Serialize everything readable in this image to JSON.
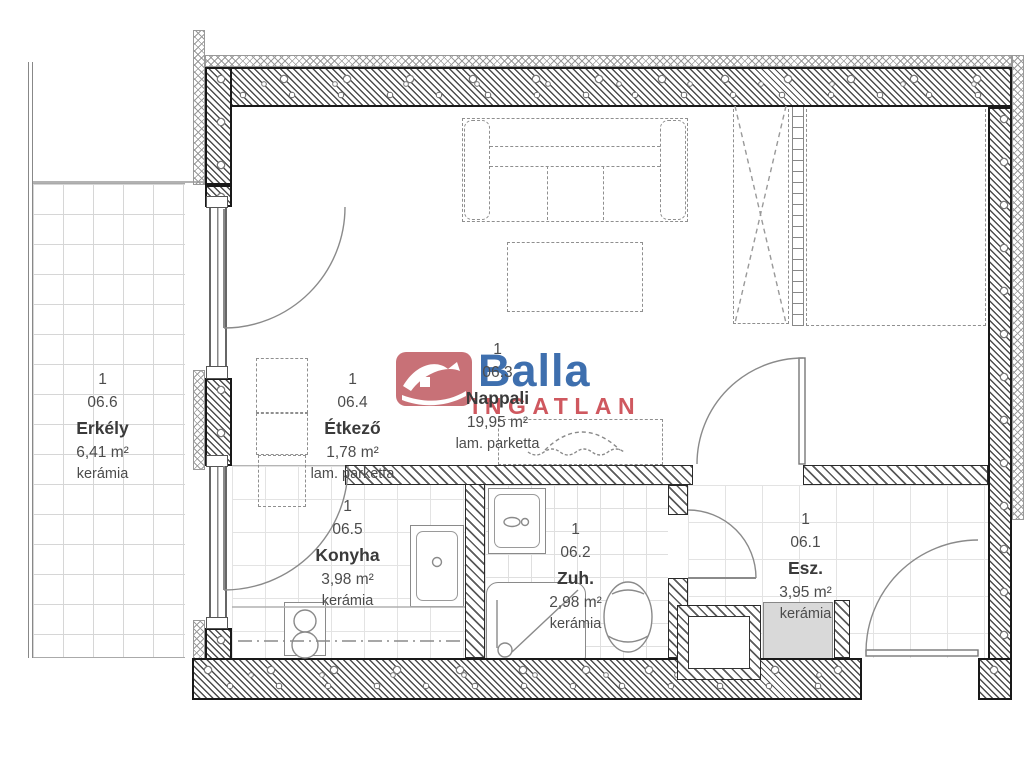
{
  "watermark": {
    "brand": "Balla",
    "sub": "INGATLAN"
  },
  "colors": {
    "brand_blue": "#2e63a8",
    "brand_red": "#cb4a52",
    "house_red": "#c4666c"
  },
  "rooms": {
    "erkely": {
      "level": "1",
      "code": "06.6",
      "name": "Erkély",
      "area": "6,41 m²",
      "finish": "kerámia"
    },
    "etkezo": {
      "level": "1",
      "code": "06.4",
      "name": "Étkező",
      "area": "1,78 m²",
      "finish": "lam. parketta"
    },
    "nappali": {
      "level": "1",
      "code": "06.3",
      "name": "Nappali",
      "area": "19,95 m²",
      "finish": "lam. parketta"
    },
    "konyha": {
      "level": "1",
      "code": "06.5",
      "name": "Konyha",
      "area": "3,98 m²",
      "finish": "kerámia"
    },
    "zuh": {
      "level": "1",
      "code": "06.2",
      "name": "Zuh.",
      "area": "2,98 m²",
      "finish": "kerámia"
    },
    "esz": {
      "level": "1",
      "code": "06.1",
      "name": "Esz.",
      "area": "3,95 m²",
      "finish": "kerámia"
    }
  }
}
